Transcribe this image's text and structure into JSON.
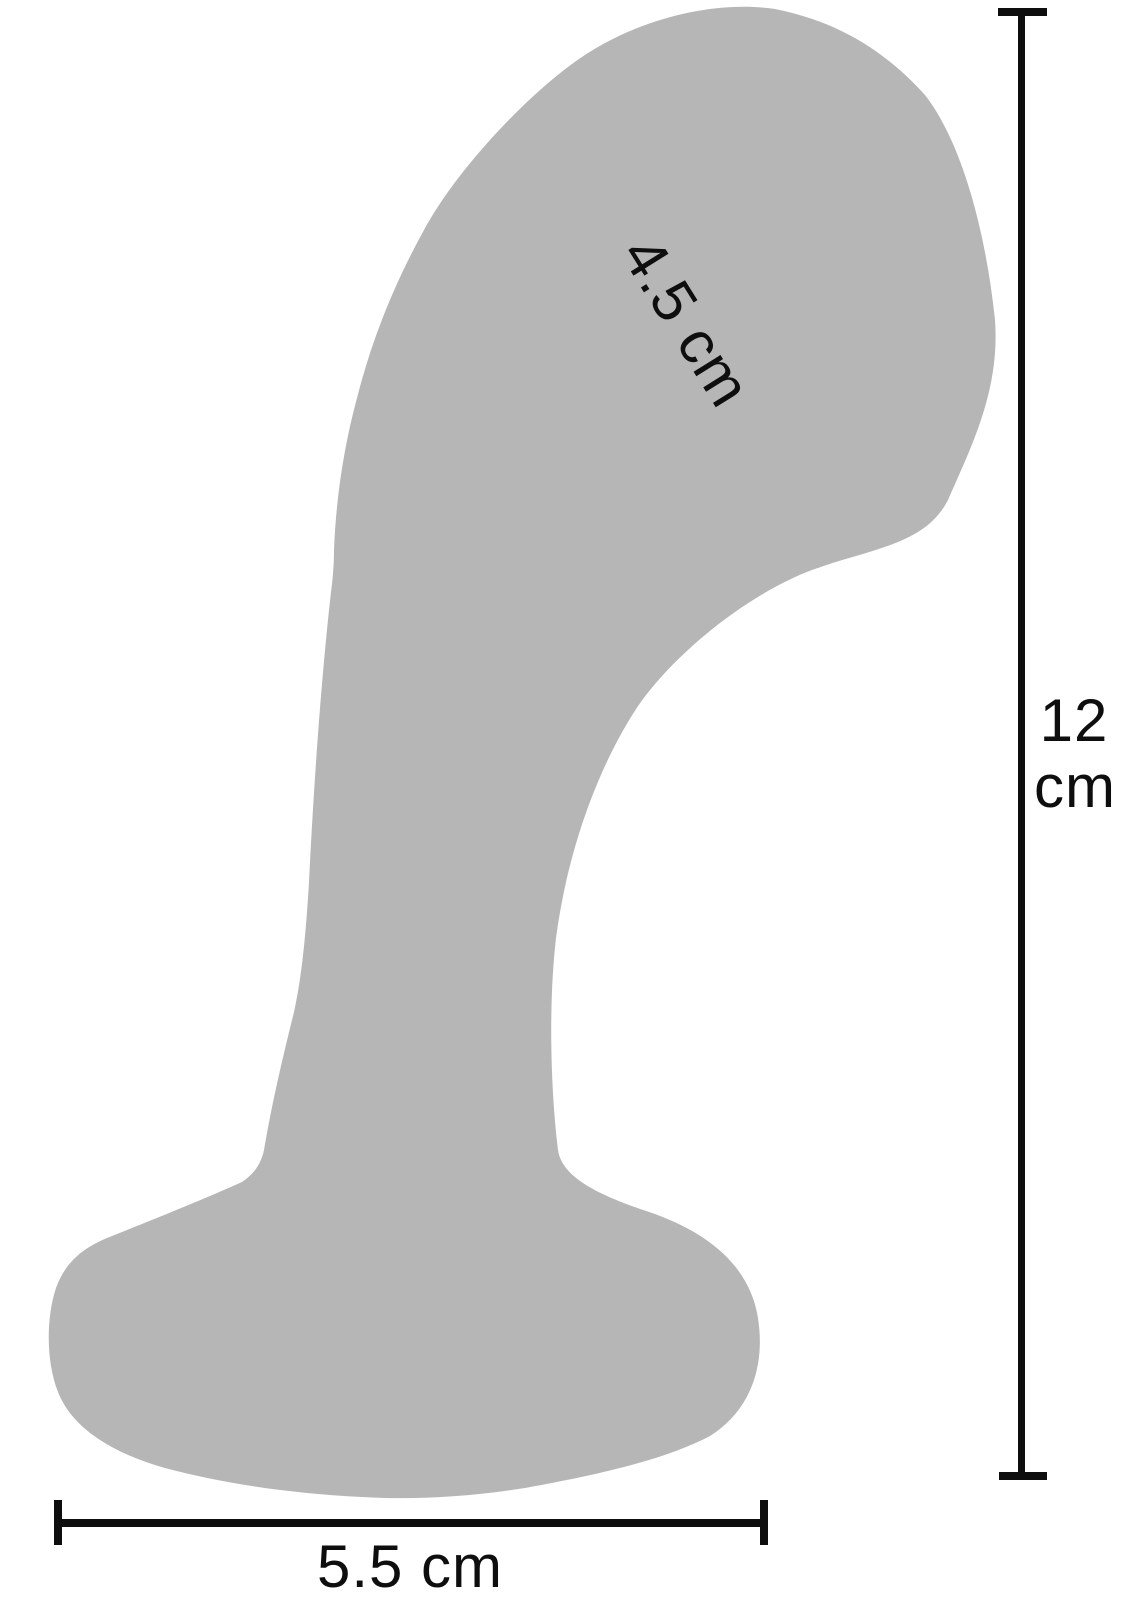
{
  "figure": {
    "background_color": "#ffffff",
    "silhouette_color": "#b6b6b6",
    "dimension_color": "#0e0e0e",
    "measurements": {
      "head_diameter": {
        "text": "4.5 cm",
        "value": "4.5",
        "unit": "cm",
        "orientation": "diagonal"
      },
      "total_length": {
        "text": "12 cm",
        "value": "12",
        "unit": "cm",
        "orientation": "vertical"
      },
      "base_width": {
        "text": "5.5 cm",
        "value": "5.5",
        "unit": "cm",
        "orientation": "horizontal"
      }
    }
  }
}
